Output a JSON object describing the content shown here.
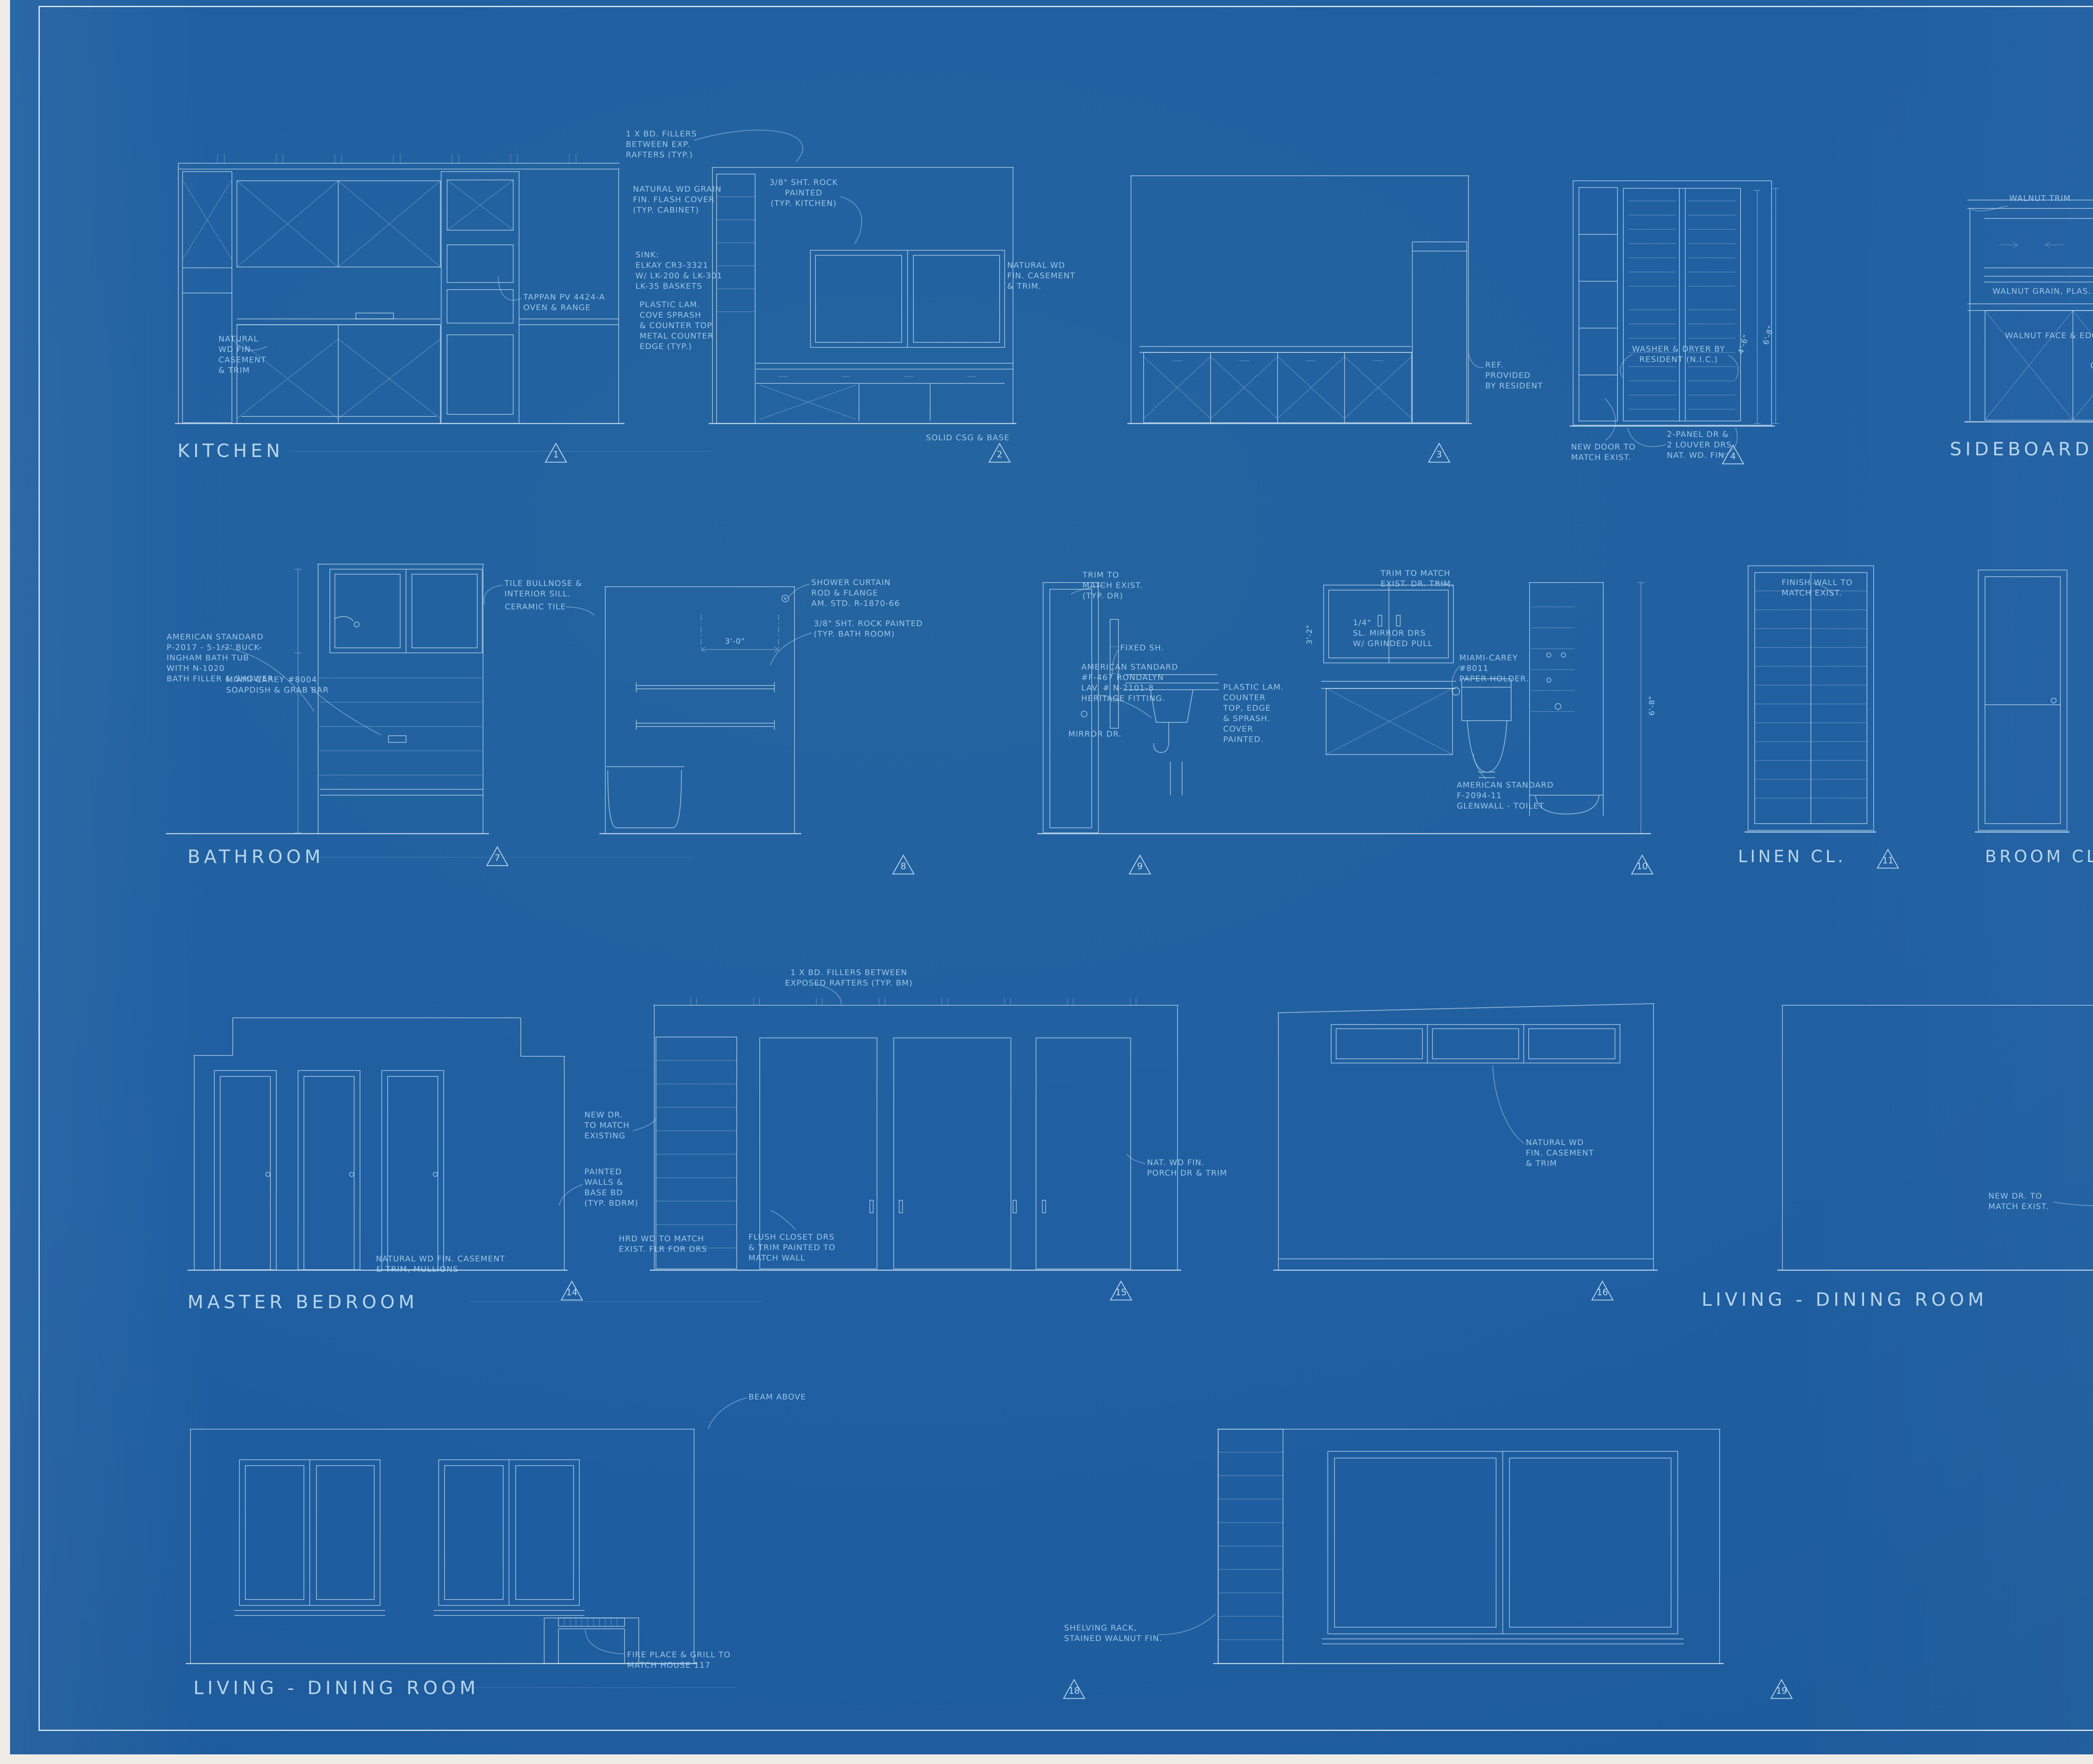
{
  "palette": {
    "sheet_blue": "#1f5fa2",
    "line_blue": "#cfe3f2",
    "hand_blue": "#a8cfeb",
    "print_white": "#f6fafd"
  },
  "rooms": {
    "kitchen": "KITCHEN",
    "sideboard": "SIDEBOARD",
    "bathroom": "BATHROOM",
    "linen": "LINEN CL.",
    "broom": "BROOM CL.",
    "bdrm2": "BD.RM.#2 CL.",
    "master": "MASTER BEDROOM",
    "living_upper": "LIVING - DINING ROOM",
    "living_lower": "LIVING - DINING ROOM"
  },
  "markers": {
    "m1": "1",
    "m2": "2",
    "m3": "3",
    "m4": "4",
    "m5": "5",
    "m6": "6",
    "m7": "7",
    "m8": "8",
    "m9": "9",
    "m10": "10",
    "m11": "11",
    "m12": "12",
    "m13": "13",
    "m14": "14",
    "m15": "15",
    "m16": "16",
    "m17": "17",
    "m18": "18",
    "m19": "19"
  },
  "dims": {
    "closet_w": "4'-6\"",
    "closet_h": "6'-8\"",
    "shower_w": "3'-0\"",
    "mirror_h": "3'-2\"",
    "bath_h": "6'-8\""
  },
  "notes": {
    "rafters_kitchen": "1 X BD. FILLERS\nBETWEEN EXP.\nRAFTERS (TYP.)",
    "flash_cover": "NATURAL WD GRAIN\nFIN. FLASH COVER\n(TYP. CABINET)",
    "sheetrock_kitchen": "3/8\" SHT. ROCK PAINTED\n(TYP. KITCHEN)",
    "sink": "SINK:\nELKAY CR3-3321\nW/ LK-200 & LK-301\nLK-35 BASKETS",
    "plastic_lam_kitchen": "PLASTIC LAM.\nCOVE SPRASH\n& COUNTER TOP.\nMETAL COUNTER\nEDGE (TYP.)",
    "casement_k1": "NATURAL\nWD FIN.\nCASEMENT\n& TRIM",
    "tappan": "TAPPAN PV 4424-A\nOVEN & RANGE",
    "casement_k3": "NATURAL WD\nFIN. CASEMENT\n& TRIM.",
    "scribe": "SOLID CSG & BASE",
    "ref": "REF.\nPROVIDED\nBY RESIDENT",
    "washer": "WASHER & DRYER BY\nRESIDENT (N.I.C.)",
    "new_door_k4": "NEW DOOR TO\nMATCH EXIST.",
    "louver": "2-PANEL DR &\n2 LOUVER DRS\nNAT. WD. FIN.",
    "walnut_trim": "WALNUT TRIM",
    "walnut_lam": "WALNUT GRAIN, PLAS. LAM",
    "walnut_face": "WALNUT FACE & EDGE",
    "glass_doors": "GLS. SLIDING\nDOORS",
    "glass_shelves": "1/4\" PL. GLS. SHLVES",
    "lightolier": "LIGHTOLIER\n\"LYTE LINE\" #20255",
    "grasscloth": "GRASS CLOTH,\nOVER\nSHT. ROCK",
    "eggcrate": "CONCEALED\nEGGCRATE (N.I.C.)",
    "bullnose": "TILE BULLNOSE &\nINTERIOR SILL.",
    "ceramic": "CERAMIC TILE",
    "curtain": "SHOWER CURTAIN\nROD & FLANGE\nAM. STD. R-1870-66",
    "sheetrock_bath": "3/8\" SHT. ROCK PAINTED\n(TYP. BATH ROOM)",
    "tub": "AMERICAN STANDARD\nP-2017 - 5-1/2' BUCK-\nINGHAM BATH TUB\nWITH N-1020\nBATH FILLER & SHOWER",
    "soapdish": "MIAMI-CAREY #8004\nSOAPDISH & GRAB BAR",
    "trim_door": "TRIM TO\nMATCH EXIST.\n(TYP. DR)",
    "trim_match": "TRIM TO MATCH\nEXIST. DR. TRIM.",
    "fixed_sh": "FIXED SH.",
    "mirror_dr": "MIRROR DR.",
    "lavatory": "AMERICAN STANDARD\n#F-467 RONDALYN\nLAV. # N-2101-8\nHERITAGE FITTING.",
    "plastic_lam_bath": "PLASTIC LAM.\nCOUNTER\nTOP, EDGE\n& SPRASH.\nCOVER\nPAINTED.",
    "mirror_doors": "1/4\"\nSL. MIRROR DRS\nW/ GRINDED PULL",
    "paper_holder": "MIAMI-CAREY\n#8011\nPAPER HOLDER.",
    "toilet": "AMERICAN STANDARD\nF-2094-11\nGLENWALL - TOILET",
    "finish_wall": "FINISH WALL TO\nMATCH EXIST.",
    "pull_hole": "PULL\nHOLE",
    "finish_bdrm_dr": "FINISH TO MATCH EXIST.  BD RM. DR.",
    "rafters_bdrm": "1 X BD. FILLERS BETWEEN\nEXPOSED RAFTERS (TYP. BM)",
    "new_dr_bdrm": "NEW DR.\nTO MATCH\nEXISTING",
    "painted_walls": "PAINTED\nWALLS &\nBASE BD\n(TYP. BDRM)",
    "hrd_wd": "HRD WD TO MATCH\nEXIST. FLR FOR DRS",
    "flush_closet": "FLUSH CLOSET DRS\n& TRIM PAINTED TO\nMATCH WALL",
    "porch_dr": "NAT. WD FIN.\nPORCH DR & TRIM",
    "mullions": "NATURAL WD FIN. CASEMENT\n& TRIM, MULLIONS",
    "casement_m3": "NATURAL WD\nFIN. CASEMENT\n& TRIM",
    "new_dr_ld": "NEW DR. TO\nMATCH EXIST.",
    "beam": "BEAM ABOVE",
    "fireplace": "FIRE PLACE & GRILL TO\nMATCH HOUSE 117",
    "shelving": "SHELVING RACK,\nSTAINED WALNUT FIN."
  },
  "title_block": {
    "project_line1": "HOUSE 129 REMODELING",
    "project_line2": "INTERIOR ELEVATION",
    "client_line1": "TECOYA EMPLOYEE HOUSING #117 & #129",
    "client_line2": "YOSEMITE PARK & CURRY CO.",
    "client_line3": "YOSEMITE NATIONAL PARK, CALIF.",
    "firm_name": "SPENCER, LEE & BUSSE",
    "firm_dot": "·",
    "firm_type": "ARCHITECTS",
    "principal1": "ELDRIDGE T. SPENCER, F.A.I.A.",
    "principal2": "ALTON S. LEE, A.I.A.",
    "principal3": "WILLIAM H. BUSSE, A.I.A.",
    "address1_street": "251 KEARNY STREET",
    "address1_city": "SAN FRANCISCO, CALIFORNIA",
    "address2_street": "405 TOWN & COUNTRY VILLAGE",
    "address2_city": "PALO ALTO, CALIFORNIA",
    "drawing_number_label": "DRAWING\nNUMBER",
    "drawing_number": "5",
    "drawing_number_of": "OF 7",
    "job_number_label": "JOB\nNUMBER",
    "job_number": "6430",
    "scale_label": "SCALE",
    "scale_value": "1/2\"=1'-0\"",
    "date_label": "DATE",
    "date_value": "4-11-66",
    "by_label": "BY",
    "certificate_label": "CERTIFICATE NO."
  }
}
